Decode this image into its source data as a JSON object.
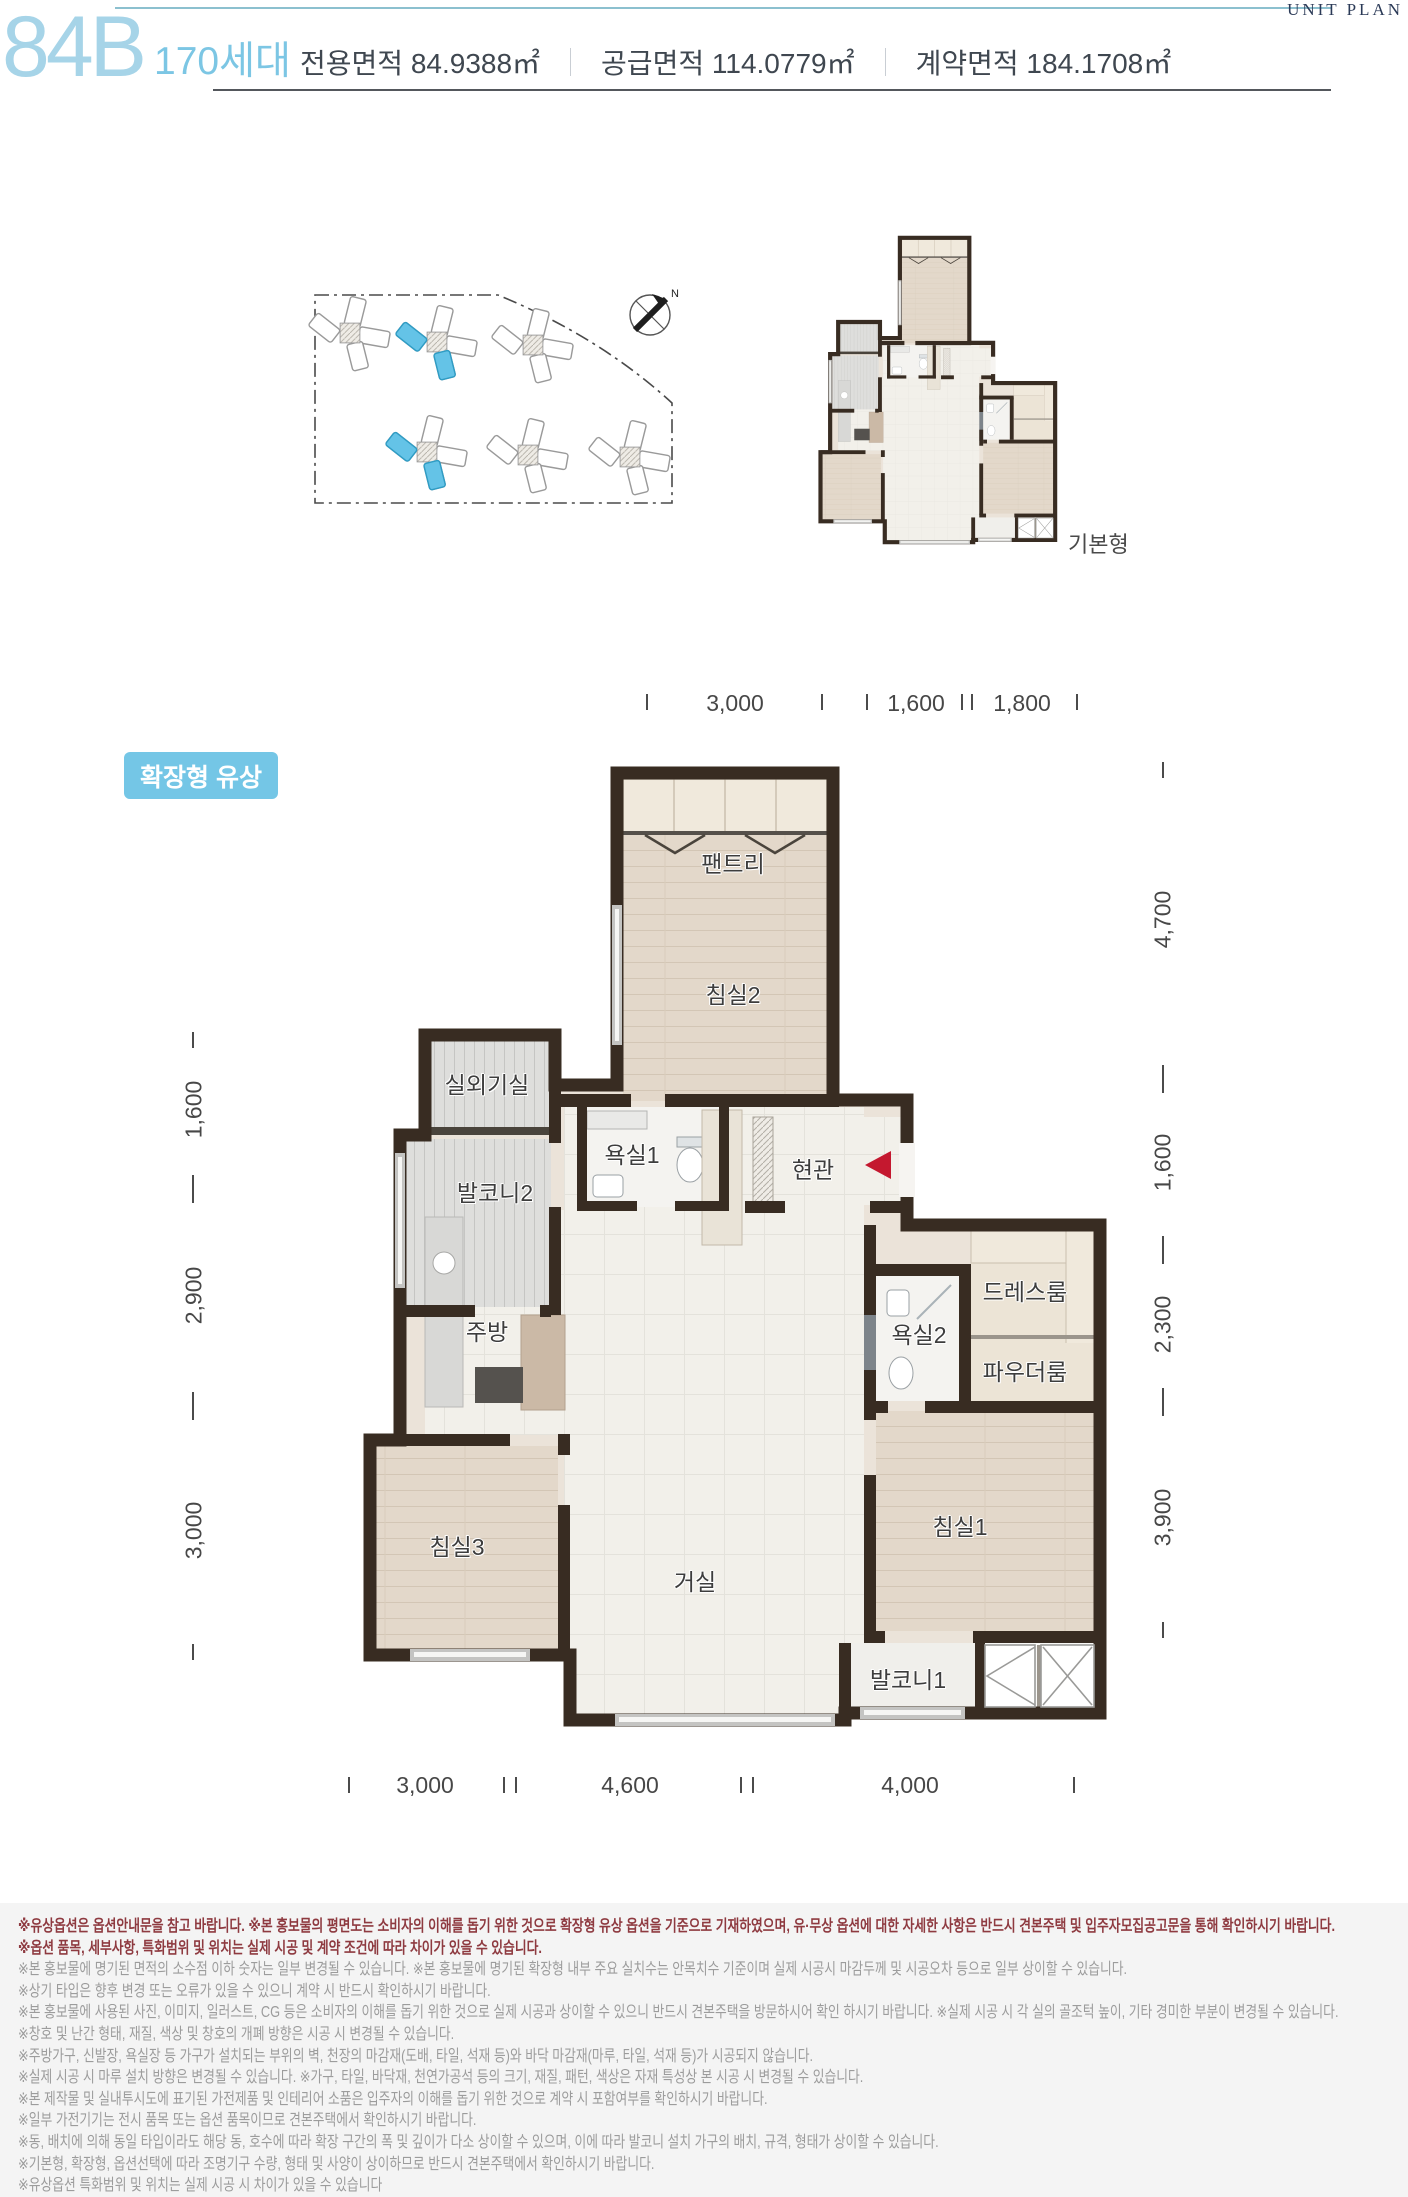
{
  "header": {
    "unit_code": "84B",
    "households": "170세대",
    "areas": [
      {
        "label": "전용면적",
        "value": "84.9388㎡"
      },
      {
        "label": "공급면적",
        "value": "114.0779㎡"
      },
      {
        "label": "계약면적",
        "value": "184.1708㎡"
      }
    ],
    "corner_label": "UNIT PLAN"
  },
  "site_plan": {
    "compass": "N"
  },
  "mini_plan": {
    "label": "기본형"
  },
  "main_plan": {
    "badge": "확장형 유상",
    "rooms": [
      {
        "label": "팬트리"
      },
      {
        "label": "침실2"
      },
      {
        "label": "실외기실"
      },
      {
        "label": "발코니2"
      },
      {
        "label": "욕실1"
      },
      {
        "label": "현관"
      },
      {
        "label": "주방"
      },
      {
        "label": "드레스룸"
      },
      {
        "label": "욕실2"
      },
      {
        "label": "파우더룸"
      },
      {
        "label": "침실3"
      },
      {
        "label": "거실"
      },
      {
        "label": "침실1"
      },
      {
        "label": "발코니1"
      }
    ]
  },
  "dimensions": {
    "top": [
      "3,000",
      "1,600",
      "1,800"
    ],
    "bottom": [
      "3,000",
      "4,600",
      "4,000"
    ],
    "left": [
      "1,600",
      "2,900",
      "3,000"
    ],
    "right": [
      "4,700",
      "1,600",
      "2,300",
      "3,900"
    ]
  },
  "colors": {
    "accent_blue": "#74c6e6",
    "title_blue": "#a6d4e8",
    "households_blue": "#7cc6e4",
    "maroon": "#8e3a40",
    "wall": "#382c22",
    "building_highlight": "#64c3e7",
    "entrance_arrow": "#c4182f"
  },
  "disclaimer": {
    "lines": [
      "※유상옵션은 옵션안내문을 참고 바랍니다. ※본 홍보물의 평면도는 소비자의 이해를 돕기 위한 것으로 확장형 유상 옵션을 기준으로 기재하였으며, 유·무상 옵션에 대한 자세한 사항은 반드시 견본주택 및 입주자모집공고문을 통해 확인하시기 바랍니다.",
      "※옵션 품목, 세부사항, 특화범위 및 위치는 실제 시공 및 계약 조건에 따라 차이가 있을 수 있습니다.",
      "※본 홍보물에 명기된 면적의 소수점 이하 숫자는 일부 변경될 수 있습니다. ※본 홍보물에 명기된 확장형 내부 주요 실치수는 안목치수 기준이며 실제 시공시 마감두께 및 시공오차 등으로 일부 상이할 수 있습니다.",
      "※상기 타입은 향후 변경 또는 오류가 있을 수 있으니 계약 시 반드시 확인하시기 바랍니다.",
      "※본 홍보물에 사용된 사진, 이미지, 일러스트, CG 등은 소비자의 이해를 돕기 위한 것으로 실제 시공과 상이할 수 있으니 반드시 견본주택을 방문하시어 확인 하시기 바랍니다. ※실제 시공 시 각 실의 골조턱 높이, 기타 경미한 부분이 변경될 수 있습니다.",
      "※창호 및 난간 형태, 재질, 색상 및 창호의 개폐 방향은 시공 시 변경될 수 있습니다.",
      "※주방가구, 신발장, 욕실장 등 가구가 설치되는 부위의 벽, 천장의 마감재(도배, 타일, 석재 등)와 바닥 마감재(마루, 타일, 석재 등)가 시공되지 않습니다.",
      "※실제 시공 시 마루 설치 방향은 변경될 수 있습니다. ※가구, 타일, 바닥재, 천연가공석 등의 크기, 재질, 패턴, 색상은 자재 특성상 본 시공 시 변경될 수 있습니다.",
      "※본 제작물 및 실내투시도에 표기된 가전제품 및 인테리어 소품은 입주자의 이해를 돕기 위한 것으로 계약 시 포함여부를 확인하시기 바랍니다.",
      "※일부 가전기기는 전시 품목 또는 옵션 품목이므로 견본주택에서 확인하시기 바랍니다.",
      "※동, 배치에 의해 동일 타입이라도 해당 동, 호수에 따라 확장 구간의 폭 및 깊이가 다소 상이할 수 있으며, 이에 따라 발코니 설치 가구의 배치, 규격, 형태가 상이할 수 있습니다.",
      "※기본형, 확장형, 옵션선택에 따라 조명기구 수량, 형태 및 사양이 상이하므로 반드시 견본주택에서 확인하시기 바랍니다.",
      "※유상옵션 특화범위 및 위치는 실제 시공 시 차이가 있을 수 있습니다"
    ]
  }
}
